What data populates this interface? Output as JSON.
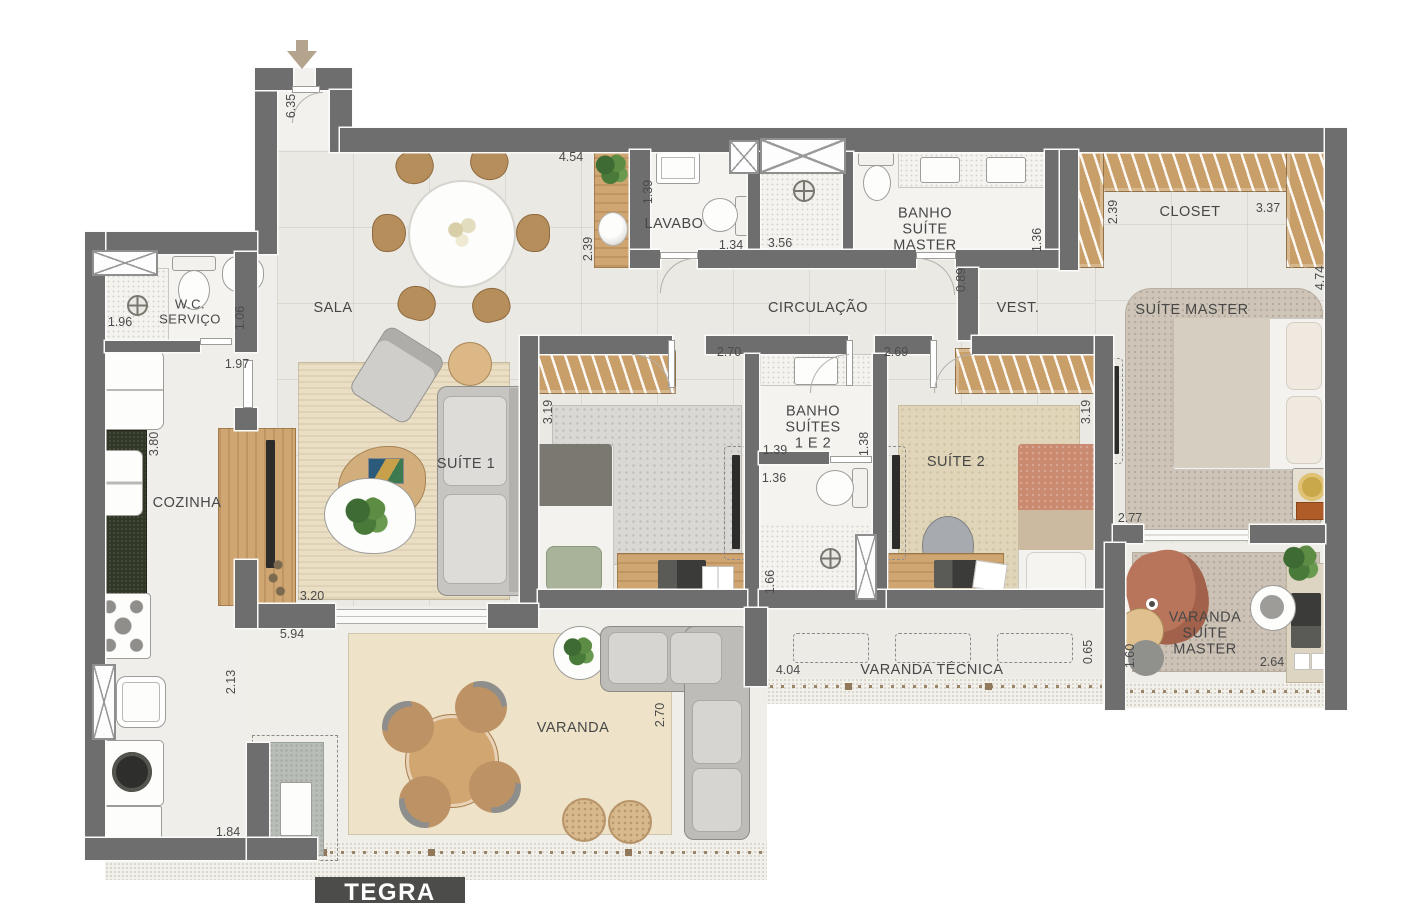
{
  "brand": {
    "name": "TEGRA",
    "sub": "ID"
  },
  "rooms": {
    "sala": "SALA",
    "wc1": "W.C.",
    "wc2": "SERVIÇO",
    "cozinha": "COZINHA",
    "lavabo": "LAVABO",
    "banho_master1": "BANHO",
    "banho_master2": "SUÍTE",
    "banho_master3": "MASTER",
    "circulacao": "CIRCULAÇÃO",
    "vest": "VEST.",
    "closet": "CLOSET",
    "suite_master": "SUÍTE MASTER",
    "suite1": "SUÍTE 1",
    "suite2": "SUÍTE 2",
    "banho_suites1": "BANHO",
    "banho_suites2": "SUÍTES",
    "banho_suites3": "1 E 2",
    "varanda": "VARANDA",
    "varanda_tecnica": "VARANDA TÉCNICA",
    "vsm1": "VARANDA",
    "vsm2": "SUÍTE",
    "vsm3": "MASTER"
  },
  "dims": {
    "hall_635": "6.35",
    "sala_454": "4.54",
    "sala_239": "2.39",
    "lavabo_139": "1.39",
    "lavabo_134": "1.34",
    "banho_356": "3.56",
    "banho_136": "1.36",
    "closet_239": "2.39",
    "closet_337": "3.37",
    "right_474": "4.74",
    "wc_196": "1.96",
    "wc_106": "1.06",
    "coz_197": "1.97",
    "circ_089": "0.89",
    "s1_270": "2.70",
    "s2_269": "2.69",
    "s1_319": "3.19",
    "s2_319": "3.19",
    "coz_380": "3.80",
    "bs_139": "1.39",
    "bs_138": "1.38",
    "bs_136": "1.36",
    "bs_166": "1.66",
    "sm_277": "2.77",
    "sala_320": "3.20",
    "sala_594": "5.94",
    "serv_213": "2.13",
    "serv_184": "1.84",
    "vt_404": "4.04",
    "vt_065": "0.65",
    "vsm_160": "1.60",
    "vsm_264": "2.64",
    "var_270": "2.70"
  }
}
